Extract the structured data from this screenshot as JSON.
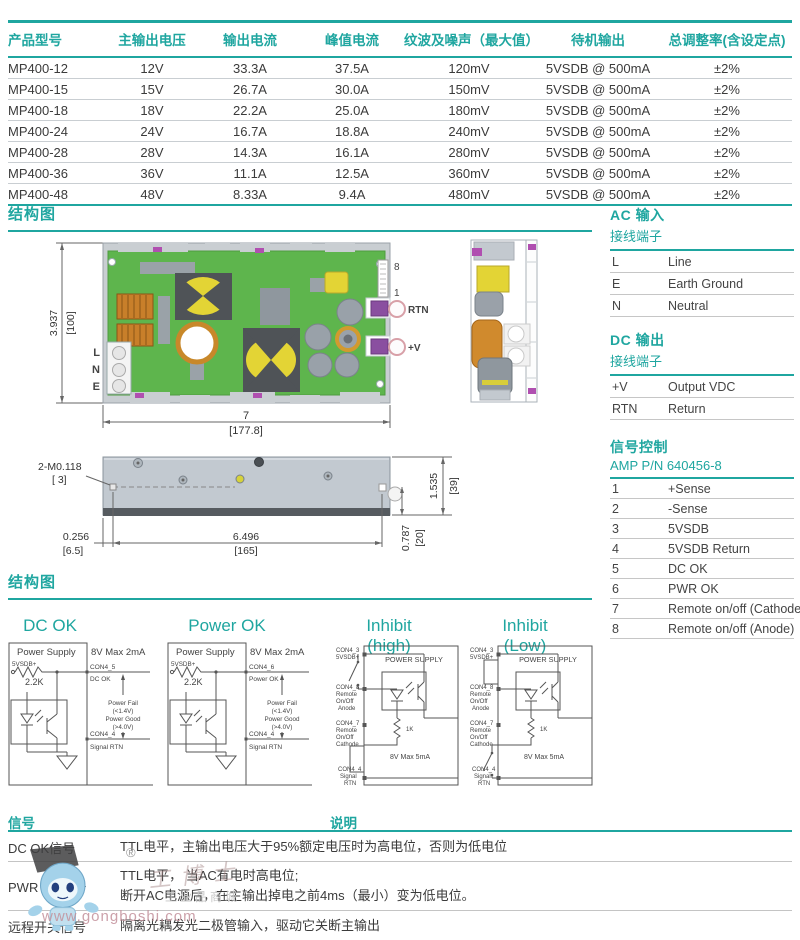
{
  "colors": {
    "teal": "#1fa6a0",
    "pcb_green": "#5eb54d",
    "copper": "#c87f2a",
    "component_yellow": "#e3d435",
    "terminal_purple": "#8a4fa0"
  },
  "spec_table": {
    "headers": [
      "产品型号",
      "主输出电压",
      "输出电流",
      "峰值电流",
      "纹波及噪声（最大值）",
      "待机输出",
      "总调整率(含设定点)"
    ],
    "rows": [
      [
        "MP400-12",
        "12V",
        "33.3A",
        "37.5A",
        "120mV",
        "5VSDB @ 500mA",
        "±2%"
      ],
      [
        "MP400-15",
        "15V",
        "26.7A",
        "30.0A",
        "150mV",
        "5VSDB @ 500mA",
        "±2%"
      ],
      [
        "MP400-18",
        "18V",
        "22.2A",
        "25.0A",
        "180mV",
        "5VSDB @ 500mA",
        "±2%"
      ],
      [
        "MP400-24",
        "24V",
        "16.7A",
        "18.8A",
        "240mV",
        "5VSDB @ 500mA",
        "±2%"
      ],
      [
        "MP400-28",
        "28V",
        "14.3A",
        "16.1A",
        "280mV",
        "5VSDB @ 500mA",
        "±2%"
      ],
      [
        "MP400-36",
        "36V",
        "11.1A",
        "12.5A",
        "360mV",
        "5VSDB @ 500mA",
        "±2%"
      ],
      [
        "MP400-48",
        "48V",
        "8.33A",
        "9.4A",
        "480mV",
        "5VSDB @ 500mA",
        "±2%"
      ]
    ]
  },
  "section_structure_1": "结构图",
  "section_structure_2": "结构图",
  "pcb_top": {
    "dim_h_in": "3.937",
    "dim_h_mm": "[100]",
    "dim_w_in": "7",
    "dim_w_mm": "[177.8]",
    "terminal_l": "L",
    "terminal_n": "N",
    "terminal_e": "E",
    "pin8": "8",
    "pin1": "1",
    "rtn": "RTN",
    "plus_v": "+V"
  },
  "side_view": {
    "screw": "2-M0.118",
    "screw_mm": "[ 3]",
    "h_in": "1.535",
    "h_mm": "[39]",
    "off_in": "0.256",
    "off_mm": "[6.5]",
    "len_in": "6.496",
    "len_mm": "[165]",
    "d_in": "0.787",
    "d_mm": "[20]"
  },
  "ac_input": {
    "title": "AC 输入",
    "subtitle": "接线端子",
    "rows": [
      [
        "L",
        "Line"
      ],
      [
        "E",
        "Earth Ground"
      ],
      [
        "N",
        "Neutral"
      ]
    ]
  },
  "dc_output": {
    "title": "DC 输出",
    "subtitle": "接线端子",
    "rows": [
      [
        "+V",
        "Output VDC"
      ],
      [
        "RTN",
        "Return"
      ]
    ]
  },
  "signal_control": {
    "title": "信号控制",
    "subtitle": "AMP P/N 640456-8",
    "rows": [
      [
        "1",
        "+Sense"
      ],
      [
        "2",
        "-Sense"
      ],
      [
        "3",
        "5VSDB"
      ],
      [
        "4",
        "5VSDB Return"
      ],
      [
        "5",
        "DC OK"
      ],
      [
        "6",
        "PWR OK"
      ],
      [
        "7",
        "Remote on/off (Cathode)"
      ],
      [
        "8",
        "Remote on/off (Anode)"
      ]
    ]
  },
  "circuits": {
    "dc_ok": {
      "title": "DC OK",
      "box": "Power Supply",
      "src": "5VSDB+",
      "res": "2.2K",
      "rating": "8V Max 2mA",
      "pin_top": "CON4_5",
      "pin_top_name": "DC OK",
      "note1": "Power Fail",
      "note2": "(<1.4V)",
      "note3": "Power Good",
      "note4": "(>4.0V)",
      "pin_bot": "CON4_4",
      "pin_bot_name": "Signal RTN"
    },
    "power_ok": {
      "title": "Power OK",
      "box": "Power Supply",
      "src": "5VSDB+",
      "res": "2.2K",
      "rating": "8V Max 2mA",
      "pin_top": "CON4_6",
      "pin_top_name": "Power OK",
      "note1": "Power Fail",
      "note2": "(<1.4V)",
      "note3": "Power Good",
      "note4": "(>4.0V)",
      "pin_bot": "CON4_4",
      "pin_bot_name": "Signal RTN"
    },
    "inhibit_high": {
      "title": "Inhibit (high)",
      "box": "POWER SUPPLY",
      "p3": "CON4_3",
      "p3b": "5VSDB+",
      "p8": "CON4_8",
      "p8b": "Remote",
      "p8c": "On/Off",
      "p8d": "Anode",
      "p7": "CON4_7",
      "p7b": "Remote",
      "p7c": "On/Off",
      "p7d": "Cathode",
      "res": "1K",
      "rating": "8V Max 5mA",
      "p4": "CON4_4",
      "p4b": "Signal",
      "p4c": "RTN"
    },
    "inhibit_low": {
      "title": "Inhibit (Low)",
      "box": "POWER SUPPLY",
      "p3": "CON4_3",
      "p3b": "5VSDB+",
      "p8": "CON4_8",
      "p8b": "Remote",
      "p8c": "On/Off",
      "p8d": "Anode",
      "p7": "CON4_7",
      "p7b": "Remote",
      "p7c": "On/Off",
      "p7d": "Cathode",
      "res": "1K",
      "rating": "8V Max 5mA",
      "p4": "CON4_4",
      "p4b": "Signal",
      "p4c": "RTN"
    }
  },
  "signal_table": {
    "col_signal": "信号",
    "col_desc": "说明",
    "rows": [
      {
        "name": "DC OK信号",
        "desc": "TTL电平，主输出电压大于95%额定电压时为高电位，否则为低电位"
      },
      {
        "name": "PWR OK信号",
        "desc": "TTL电平， 当AC有电时高电位;",
        "desc2": "断开AC电源后，在主输出掉电之前4ms（最小）变为低电位。"
      },
      {
        "name": "远程开关信号",
        "desc": "隔离光耦发光二极管输入，驱动它关断主输出"
      }
    ]
  },
  "watermark": {
    "brand": "工博士",
    "reg": "®",
    "mall": "工业品商城",
    "url": "www.gongboshi.com"
  }
}
